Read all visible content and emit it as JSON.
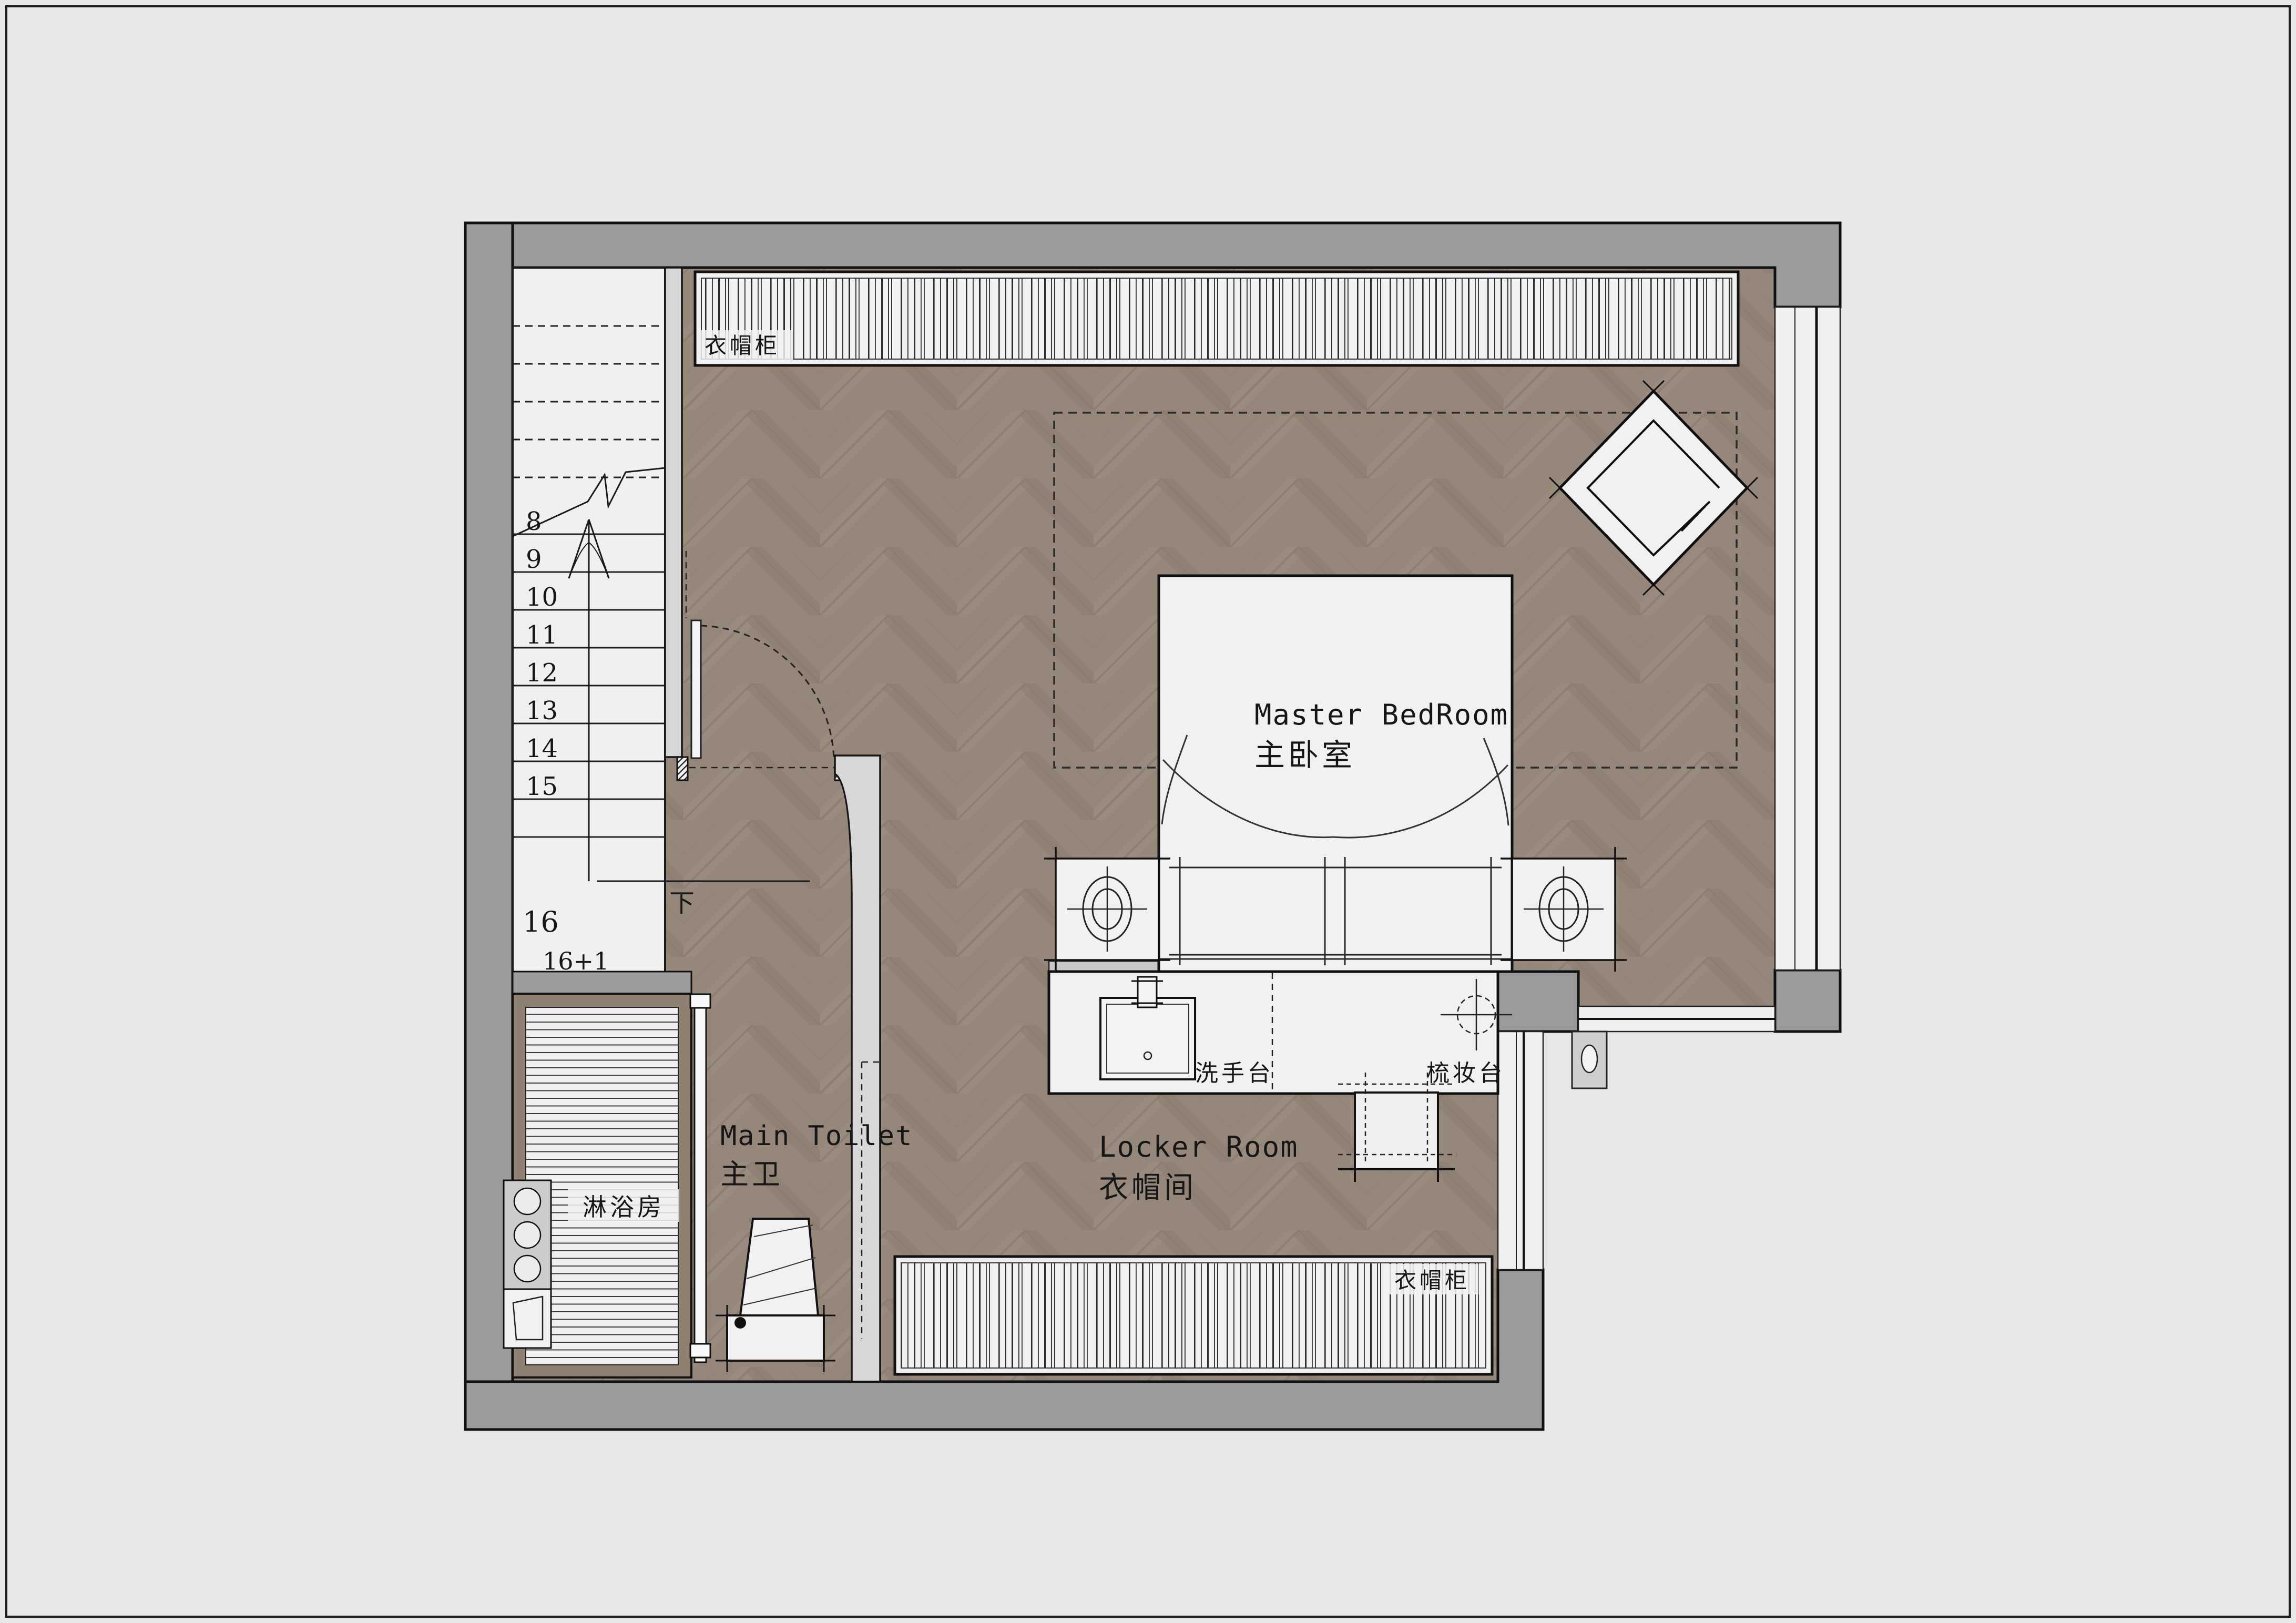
{
  "canvas": {
    "background": "#e8e7e8",
    "border_color": "#1c1c1c"
  },
  "palette": {
    "wall_gray": "#9c9b9c",
    "wall_light": "#d8d7d8",
    "floor_wood": "#95887a",
    "floor_line": "#8a7d6f",
    "fixture_white": "#f2f1f2",
    "line_black": "#111111",
    "track_wood": "#6e6252",
    "shower_frame": "#8d8071"
  },
  "rooms": {
    "master_bedroom": {
      "label_en": "Master BedRoom",
      "label_zh": "主卧室"
    },
    "main_toilet": {
      "label_en": "Main Toilet",
      "label_zh": "主卫"
    },
    "locker_room": {
      "label_en": "Locker Room",
      "label_zh": "衣帽间"
    }
  },
  "fixtures": {
    "wardrobe_top": "衣帽柜",
    "wardrobe_bottom": "衣帽柜",
    "shower": "淋浴房",
    "washbasin": "洗手台",
    "dressing_table": "梳妆台",
    "stairs_down": "下"
  },
  "stairs": {
    "numbers": [
      "8",
      "9",
      "10",
      "11",
      "12",
      "13",
      "14",
      "15",
      "16",
      "16+1"
    ]
  }
}
